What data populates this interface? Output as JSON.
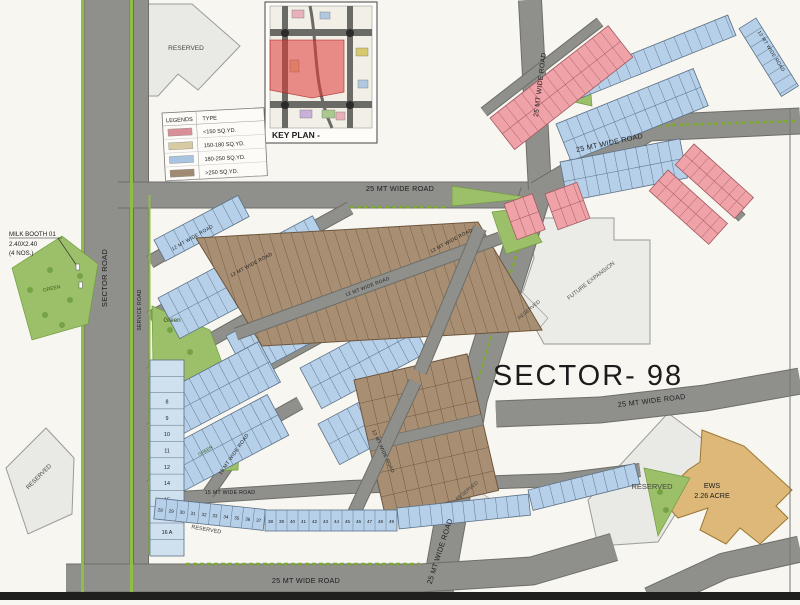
{
  "title": "SECTOR- 98",
  "colors": {
    "background": "#f8f6f0",
    "road": "#8f8f8c",
    "road_edge": "#6e6e67",
    "verge_green": "#8fbe44",
    "park_green": "#9cc069",
    "tree_green": "#6f9c3f",
    "plot_blue": "#b6d0e9",
    "plot_pink": "#efa2a7",
    "plot_brown": "#a88f73",
    "plot_tan": "#d8cba4",
    "reserved_gray": "#e9e9e6",
    "future_gray": "#ebebe8",
    "ews_gold": "#ddb878",
    "keyplan_red": "rgba(224,56,56,0.55)",
    "text_dark": "#1c1c1c"
  },
  "legend": {
    "col1": "LEGENDS",
    "col2": "TYPE",
    "rows": [
      {
        "label": "<150 SQ.YD.",
        "color": "#d98f97"
      },
      {
        "label": "150-180 SQ.YD.",
        "color": "#d8cba4"
      },
      {
        "label": "180-250 SQ.YD.",
        "color": "#a9c4e0"
      },
      {
        "label": ">250 SQ.YD.",
        "color": "#a08a72"
      }
    ]
  },
  "key_plan": {
    "label": "KEY PLAN -"
  },
  "road_labels": {
    "r25": "25 MT WIDE ROAD",
    "r15": "15 MT WIDE ROAD",
    "r12": "12 MT WIDE ROAD",
    "sector": "SECTOR ROAD",
    "service": "SERVICE ROAD"
  },
  "labels": {
    "reserved": "RESERVED",
    "future": "FUTURE EXPANSION",
    "green_uc": "GREEN",
    "green_tc": "Green",
    "ews_line1": "EWS",
    "ews_line2": "2.26 ACRE",
    "milk1": "MILK BOOTH 01",
    "milk2": "2.40X2.40",
    "milk3": "(4 NOS.)"
  },
  "plot_numbers": {
    "arc": [
      "28",
      "29",
      "30",
      "31",
      "32",
      "33",
      "34",
      "35",
      "36",
      "37",
      "38",
      "39",
      "40",
      "41",
      "42",
      "43",
      "44",
      "45",
      "46",
      "47",
      "48",
      "49"
    ],
    "left_column": [
      "8",
      "9",
      "10",
      "11",
      "12",
      "14",
      "15",
      "16",
      "16 A"
    ]
  }
}
